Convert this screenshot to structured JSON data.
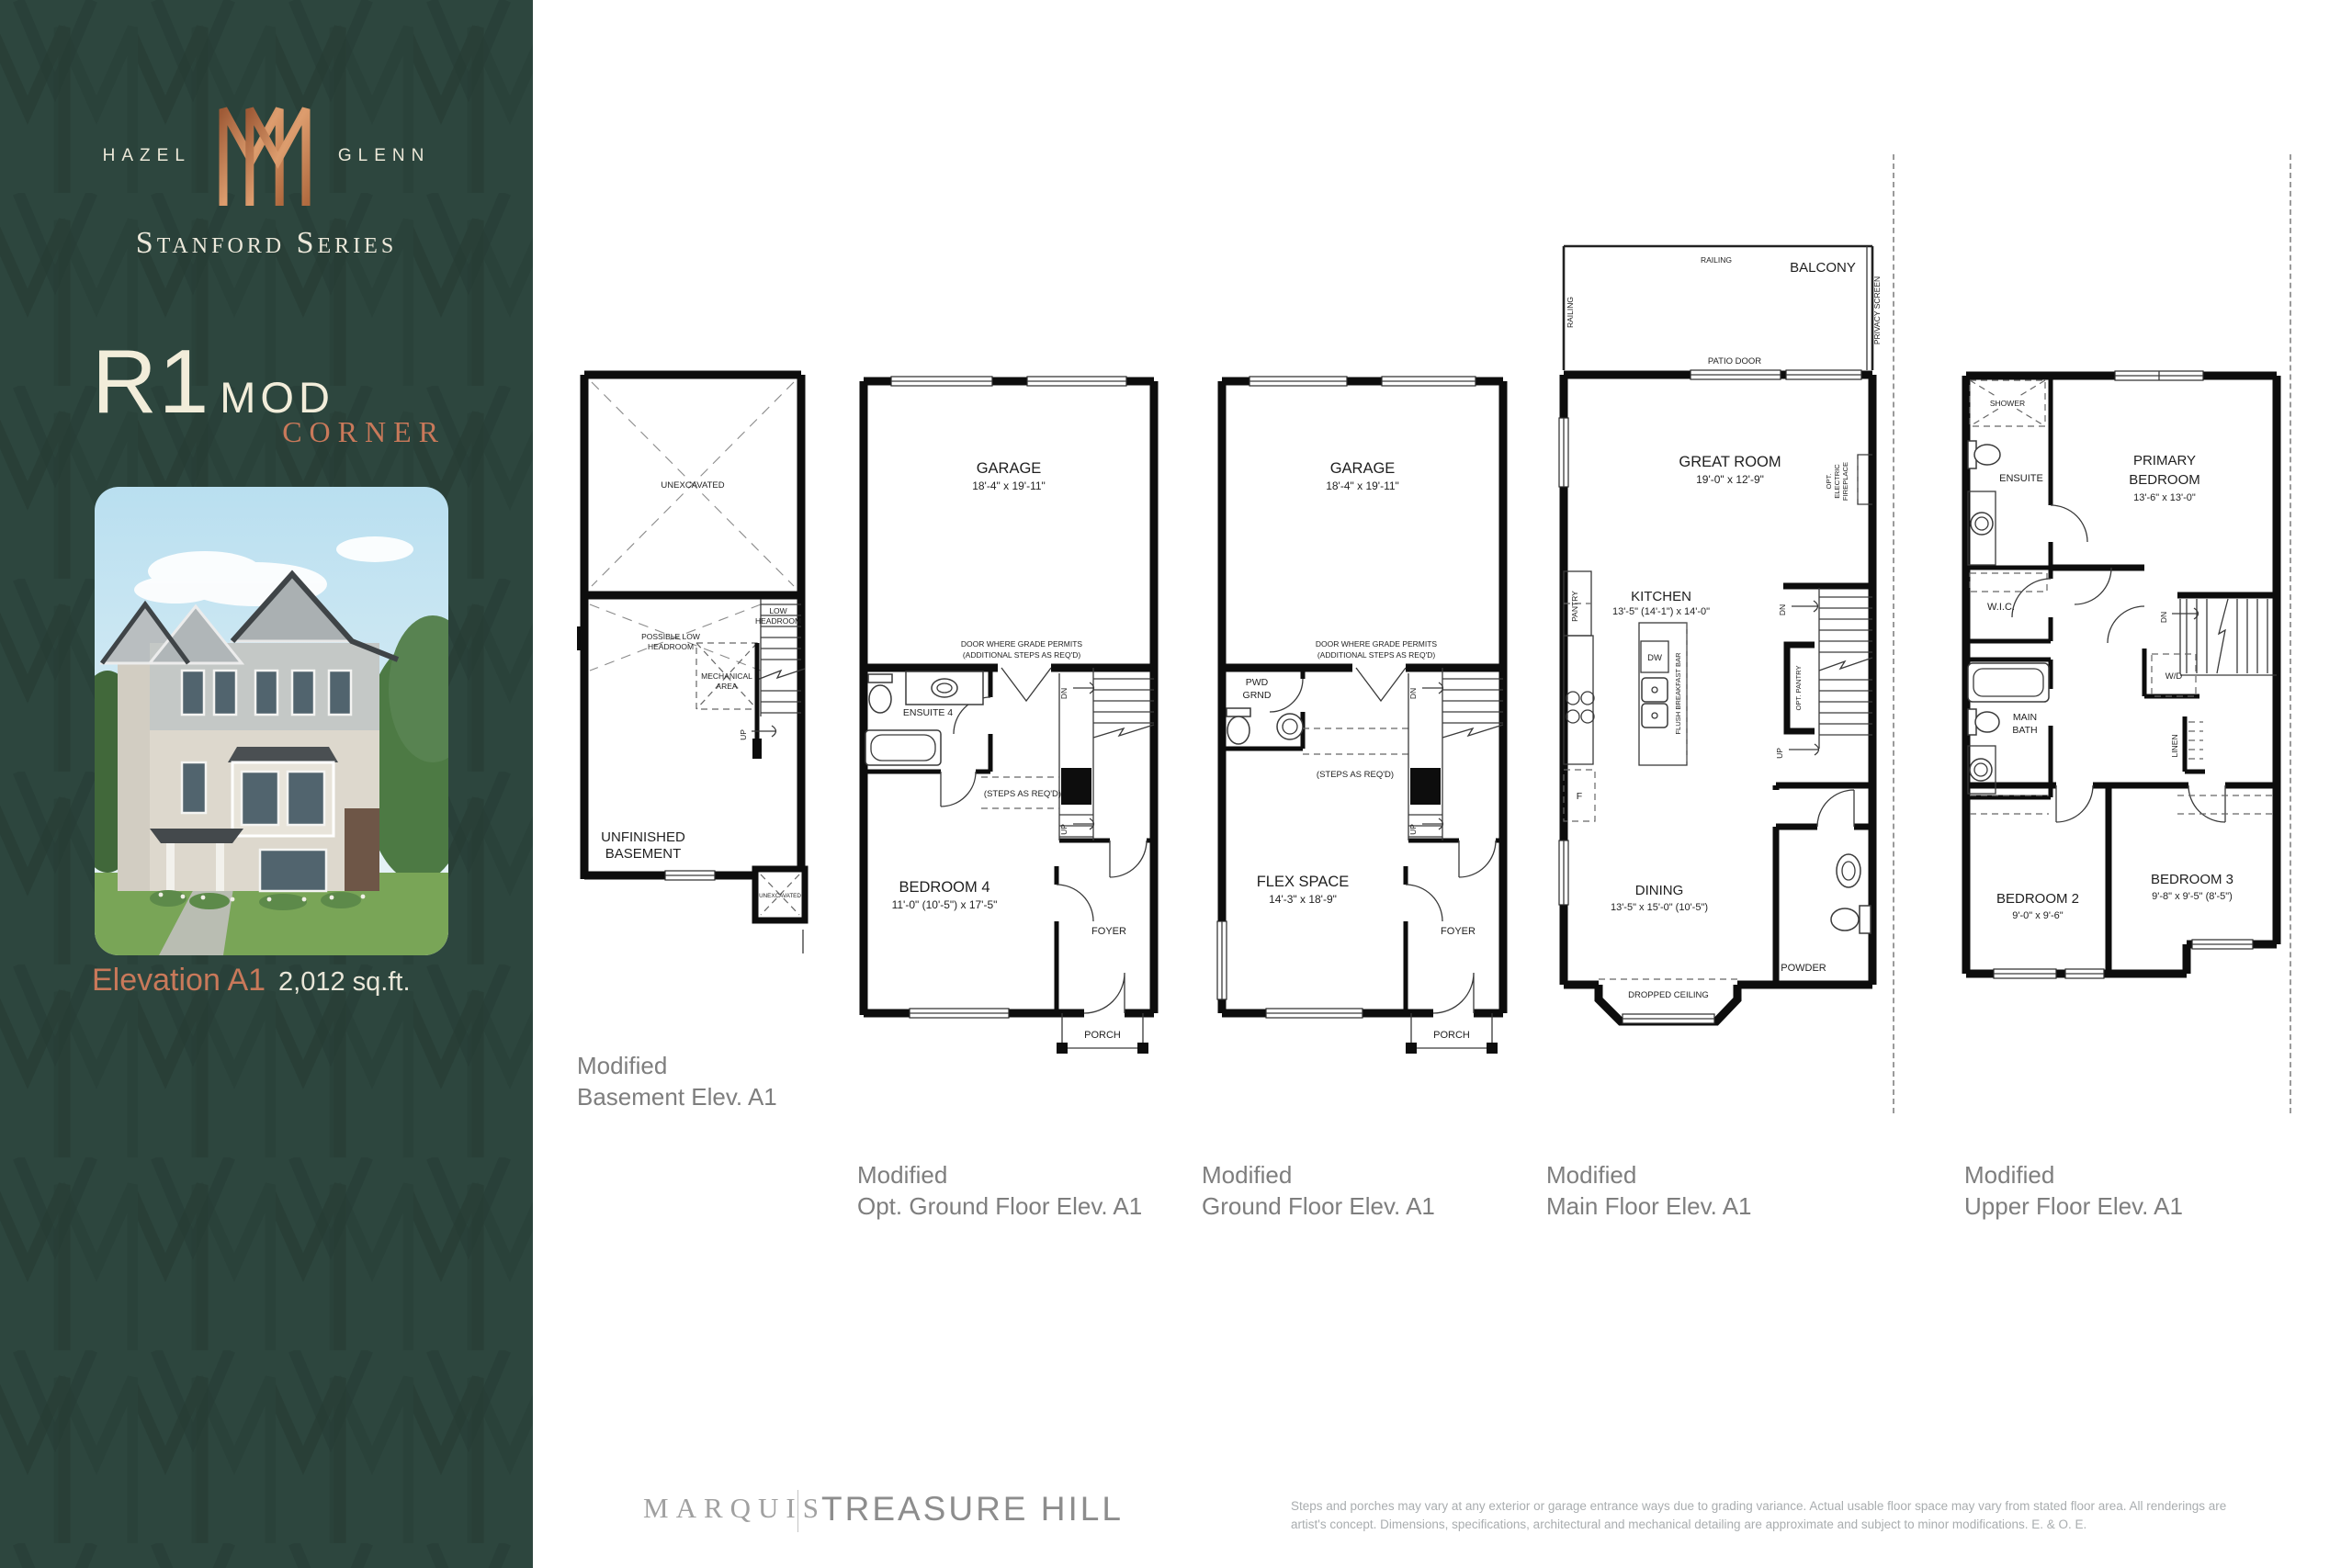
{
  "sidebar": {
    "brand_left": "HAZEL",
    "brand_right": "GLENN",
    "series": "Stanford Series",
    "model_name": "R1",
    "model_suffix": "MOD",
    "model_variant": "CORNER",
    "elevation_label": "Elevation A1",
    "area": "2,012 sq.ft."
  },
  "plans": [
    {
      "caption": [
        "Modified",
        "Basement Elev. A1"
      ],
      "labels": {
        "unexcavated": "UNEXCAVATED",
        "possible_low_headroom": [
          "POSSIBLE LOW",
          "HEADROOM"
        ],
        "low_headroom": [
          "LOW",
          "HEADROOM"
        ],
        "mechanical_area": [
          "MECHANICAL",
          "AREA"
        ],
        "up": "UP",
        "unfinished_basement": [
          "UNFINISHED",
          "BASEMENT"
        ],
        "unexcavated_small": "UNEXCAVATED"
      }
    },
    {
      "caption": [
        "Modified",
        "Opt. Ground Floor Elev. A1"
      ],
      "labels": {
        "garage": "GARAGE",
        "garage_dims": "18'-4\" x 19'-11\"",
        "door_note": [
          "DOOR WHERE GRADE PERMITS",
          "(ADDITIONAL STEPS AS REQ'D)"
        ],
        "ensuite": "ENSUITE 4",
        "dn": "DN",
        "up": "UP",
        "steps_note": "(STEPS AS REQ'D)",
        "bedroom": "BEDROOM 4",
        "bedroom_dims": "11'-0\" (10'-5\") x 17'-5\"",
        "foyer": "FOYER",
        "porch": "PORCH"
      }
    },
    {
      "caption": [
        "Modified",
        "Ground Floor Elev. A1"
      ],
      "labels": {
        "garage": "GARAGE",
        "garage_dims": "18'-4\" x 19'-11\"",
        "door_note": [
          "DOOR WHERE GRADE PERMITS",
          "(ADDITIONAL STEPS AS REQ'D)"
        ],
        "pwd": [
          "PWD",
          "GRND"
        ],
        "dn": "DN",
        "up": "UP",
        "steps_note": "(STEPS AS REQ'D)",
        "flex": "FLEX SPACE",
        "flex_dims": "14'-3\" x 18'-9\"",
        "foyer": "FOYER",
        "porch": "PORCH"
      }
    },
    {
      "caption": [
        "Modified",
        "Main Floor Elev. A1"
      ],
      "labels": {
        "railing_top": "RAILING",
        "railing_left": "RAILING",
        "balcony": "BALCONY",
        "privacy_screen": "PRIVACY SCREEN",
        "patio_door": "PATIO DOOR",
        "great_room": "GREAT ROOM",
        "great_room_dims": "19'-0\" x 12'-9\"",
        "fireplace": [
          "OPT.",
          "ELECTRIC",
          "FIREPLACE"
        ],
        "pantry": "PANTRY",
        "kitchen": "KITCHEN",
        "kitchen_dims": "13'-5\" (14'-1\") x 14'-0\"",
        "dw": "DW",
        "breakfast_bar": "FLUSH BREAKFAST BAR",
        "fridge": "F",
        "dn": "DN",
        "opt_pantry": "OPT. PANTRY",
        "up": "UP",
        "dining": "DINING",
        "dining_dims": "13'-5\" x 15'-0\" (10'-5\")",
        "powder": "POWDER",
        "dropped_ceiling": "DROPPED CEILING"
      }
    },
    {
      "caption": [
        "Modified",
        "Upper Floor Elev. A1"
      ],
      "labels": {
        "shower": "SHOWER",
        "ensuite": "ENSUITE",
        "primary": [
          "PRIMARY",
          "BEDROOM"
        ],
        "primary_dims": "13'-6\" x 13'-0\"",
        "wic": "W.I.C.",
        "dn": "DN",
        "wd": "W/D",
        "linen": "LINEN",
        "main_bath": [
          "MAIN",
          "BATH"
        ],
        "bedroom2": "BEDROOM 2",
        "bedroom2_dims": "9'-0\" x 9'-6\"",
        "bedroom3": "BEDROOM 3",
        "bedroom3_dims": "9'-8\" x 9'-5\" (8'-5\")"
      }
    }
  ],
  "footer": {
    "brand1": "MARQUIS",
    "brand2": "TREASURE HILL",
    "disclaimer": [
      "Steps and porches may vary at any exterior or garage entrance ways due to grading variance. Actual usable floor space may vary from stated floor area. All renderings are",
      "artist's concept. Dimensions, specifications, architectural and mechanical detailing are approximate and subject to minor modifications. E. & O. E."
    ]
  },
  "colors": {
    "sidebar_bg": "#2d463e",
    "cream": "#f2edda",
    "copper": "#c9795a",
    "plan_ink": "#0d0d0d",
    "caption_gray": "#7e7e7e"
  }
}
